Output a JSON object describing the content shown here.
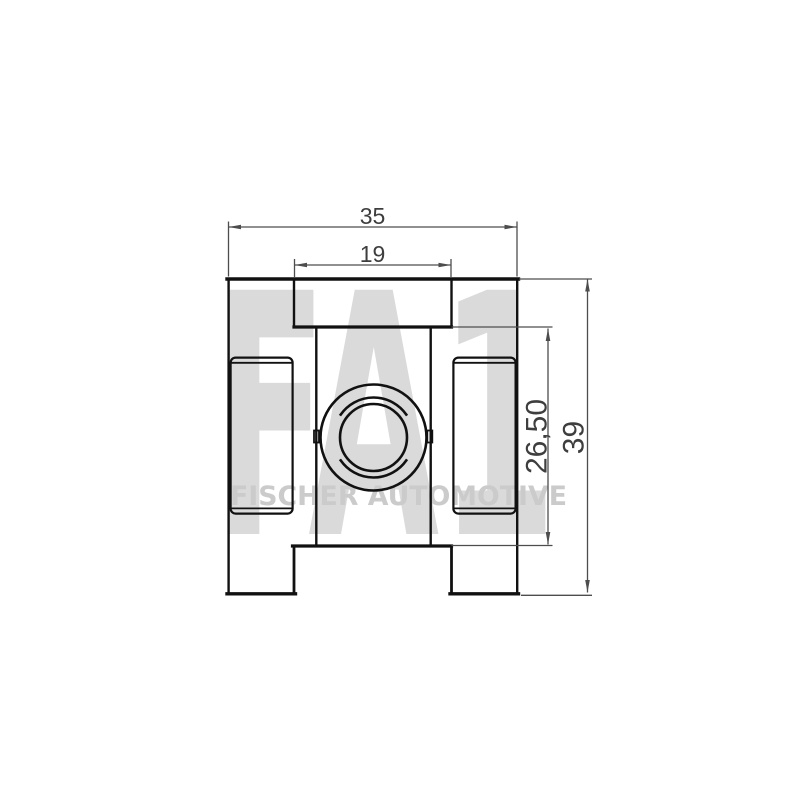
{
  "watermark": {
    "logo": "FA1",
    "subtitle": "FISCHER AUTOMOTIVE"
  },
  "dimensions": {
    "total_width": "35",
    "inner_width": "19",
    "inner_height": "26,50",
    "total_height": "39"
  },
  "colors": {
    "background": "#ffffff",
    "part_outline": "#111111",
    "dimension_lines": "#4d4d4d",
    "dimension_text": "#3e3e3e",
    "watermark_logo": "#dadada",
    "watermark_subtitle": "#cbcbcb"
  }
}
